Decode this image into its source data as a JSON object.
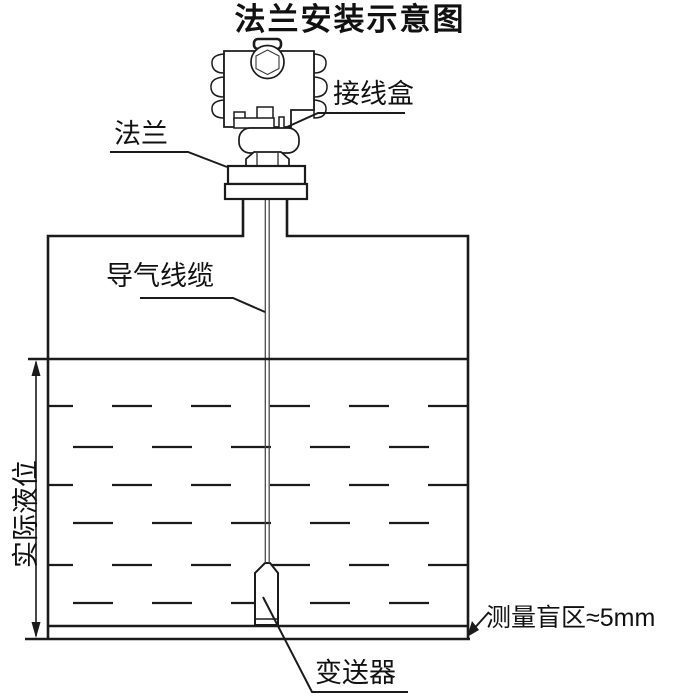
{
  "title": "法兰安装示意图",
  "labels": {
    "junction_box": "接线盒",
    "flange": "法兰",
    "air_cable": "导气线缆",
    "actual_level": "实际液位",
    "transmitter": "变送器",
    "blind_zone": "测量盲区≈5mm"
  },
  "colors": {
    "line": "#1b1b1b",
    "cable": "#4a4a4a",
    "background": "#ffffff",
    "text": "#111111"
  }
}
